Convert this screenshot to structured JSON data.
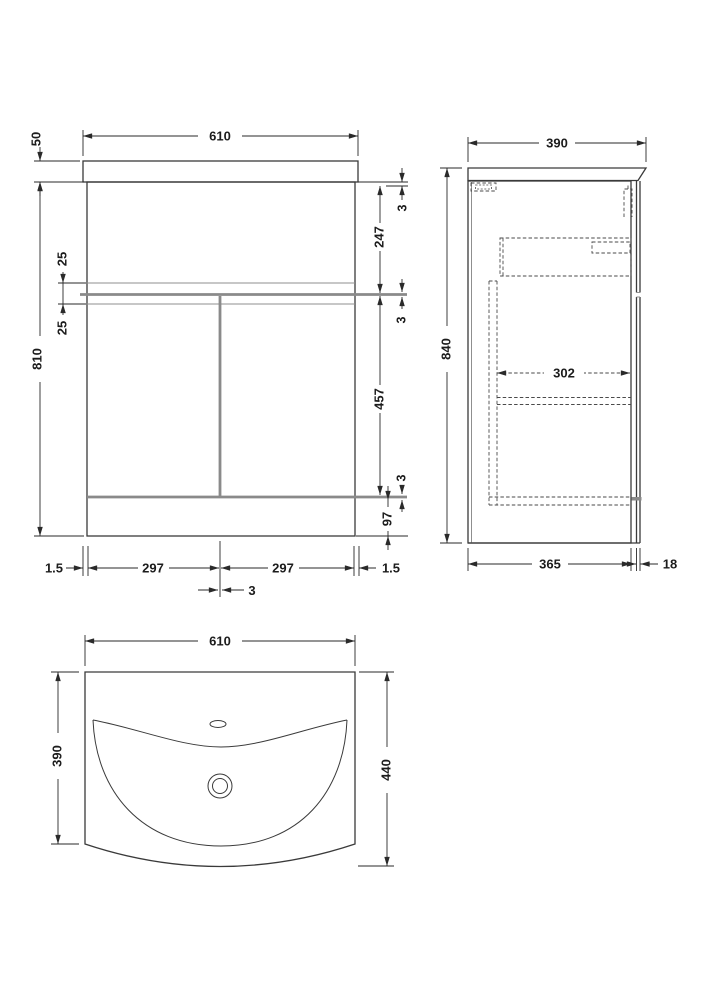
{
  "drawing": {
    "front": {
      "top_width": "610",
      "counter_height": "50",
      "cabinet_height": "810",
      "shelf_offset_upper": "25",
      "shelf_offset_lower": "25",
      "gap_top": "3",
      "upper_panel_height": "247",
      "gap_middle": "3",
      "door_height": "457",
      "gap_lower": "3",
      "plinth_height": "97",
      "edge_left": "1.5",
      "door_left_width": "297",
      "door_right_width": "297",
      "edge_right": "1.5",
      "door_gap": "3"
    },
    "side": {
      "top_depth": "390",
      "overall_height": "840",
      "drawer_internal_depth": "302",
      "carcass_depth": "365",
      "door_thickness": "18"
    },
    "plan": {
      "width": "610",
      "basin_depth": "390",
      "overall_depth": "440"
    },
    "colors": {
      "line": "#3a3a3a",
      "gap_grey": "#8a8a8a",
      "text": "#1c1c1c",
      "background": "#ffffff"
    }
  }
}
